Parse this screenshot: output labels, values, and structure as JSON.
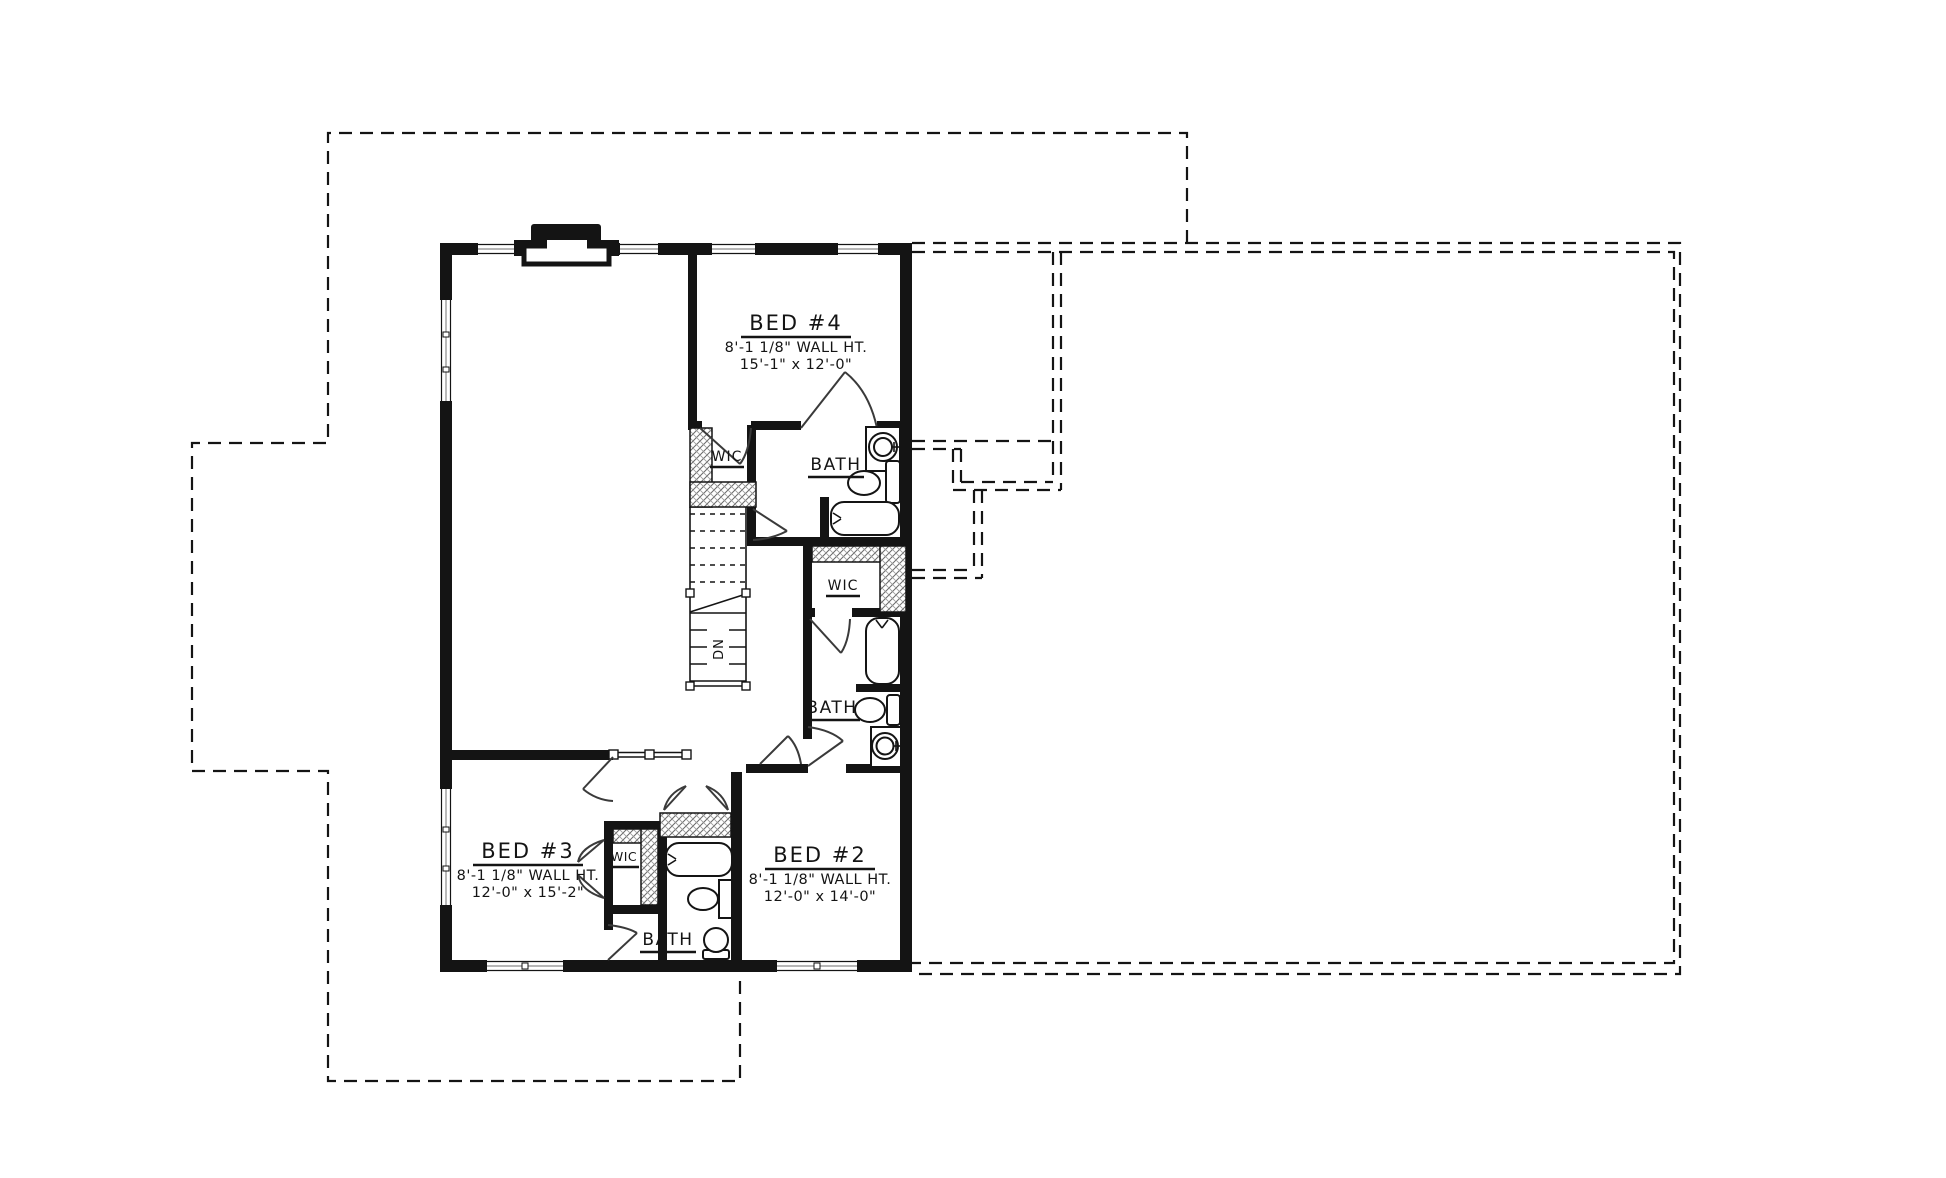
{
  "rooms": {
    "bed4": {
      "name": "BED #4",
      "wall_height": "8'-1 1/8\" WALL HT.",
      "size": "15'-1\" x 12'-0\""
    },
    "bed3": {
      "name": "BED #3",
      "wall_height": "8'-1 1/8\" WALL HT.",
      "size": "12'-0\" x 15'-2\""
    },
    "bed2": {
      "name": "BED #2",
      "wall_height": "8'-1 1/8\" WALL HT.",
      "size": "12'-0\" x 14'-0\""
    },
    "bath_bed4": {
      "name": "BATH"
    },
    "bath_bed2": {
      "name": "BATH"
    },
    "bath_bed3": {
      "name": "BATH"
    },
    "wic_bed4": {
      "name": "WIC"
    },
    "wic_bed2": {
      "name": "WIC"
    },
    "wic_bed3": {
      "name": "WIC"
    }
  },
  "stairs": {
    "direction_label": "DN"
  },
  "colors": {
    "walls": "#141414",
    "paper": "#ffffff"
  }
}
